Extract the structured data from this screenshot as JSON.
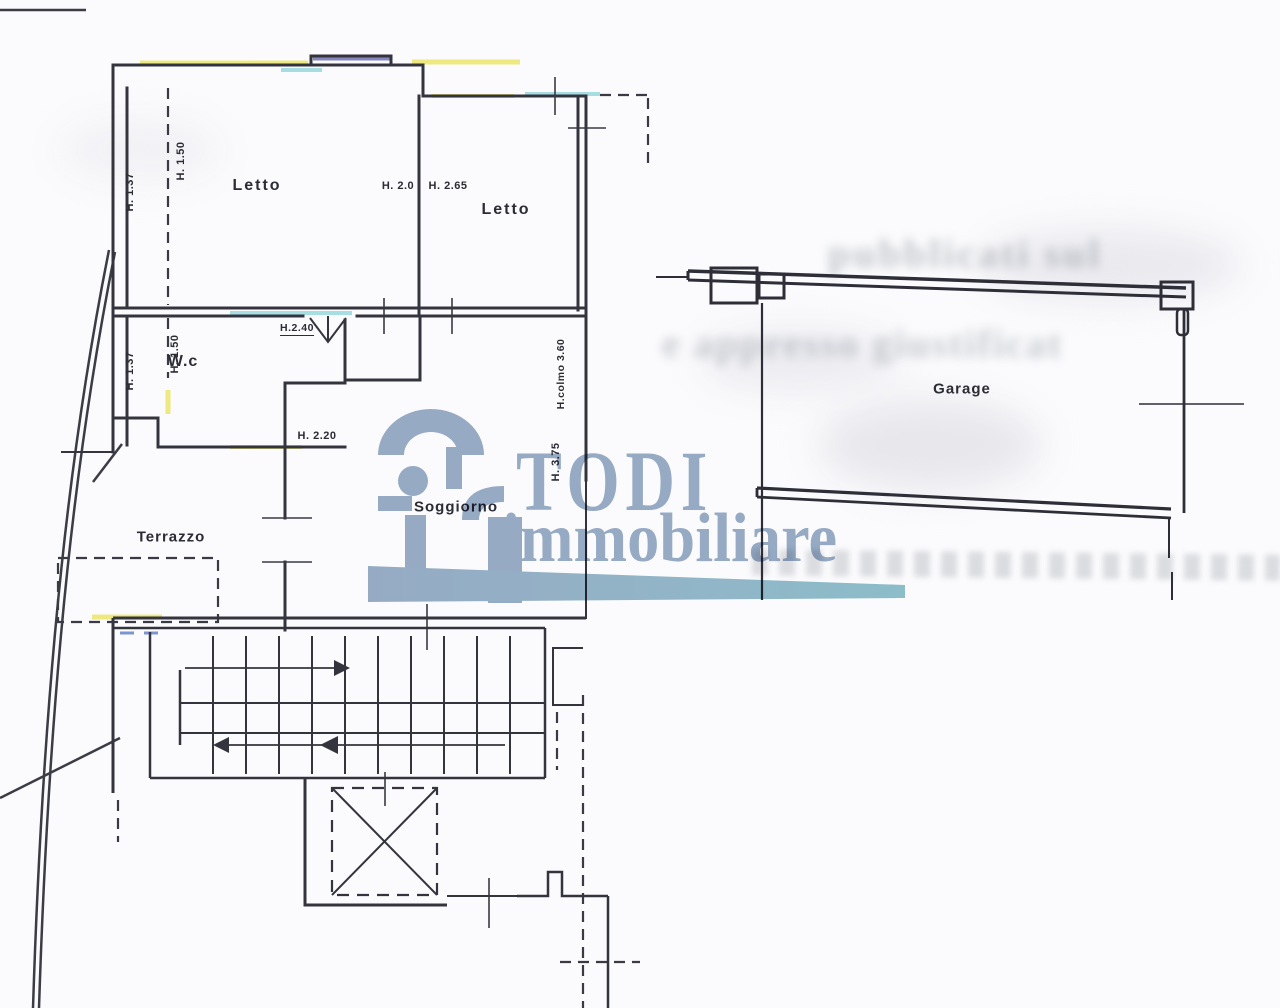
{
  "page": {
    "type": "scanned floor plan"
  },
  "watermark": {
    "brand_top": "TODI",
    "brand_bottom": "immobiliare"
  },
  "rooms": {
    "letto1": "Letto",
    "letto2": "Letto",
    "wc": "W.c",
    "soggiorno": "Soggiorno",
    "terrazzo": "Terrazzo",
    "garage": "Garage"
  },
  "measurements": {
    "letto1_h1": "H. 1.37",
    "letto1_h2": "H. 1.50",
    "letto2_h1": "H. 2.0",
    "letto2_h2": "H. 2.65",
    "wc_h1": "H. 1.37",
    "wc_h2": "H. 1.50",
    "door_h": "H.2.40",
    "hall_h": "H. 2.20",
    "roof_h": "H.colmo 3.60",
    "ridge_h": "H. 3.75"
  },
  "bleedthrough": {
    "line1": "pubblicati sul",
    "line2": "e appresso giustificat"
  }
}
